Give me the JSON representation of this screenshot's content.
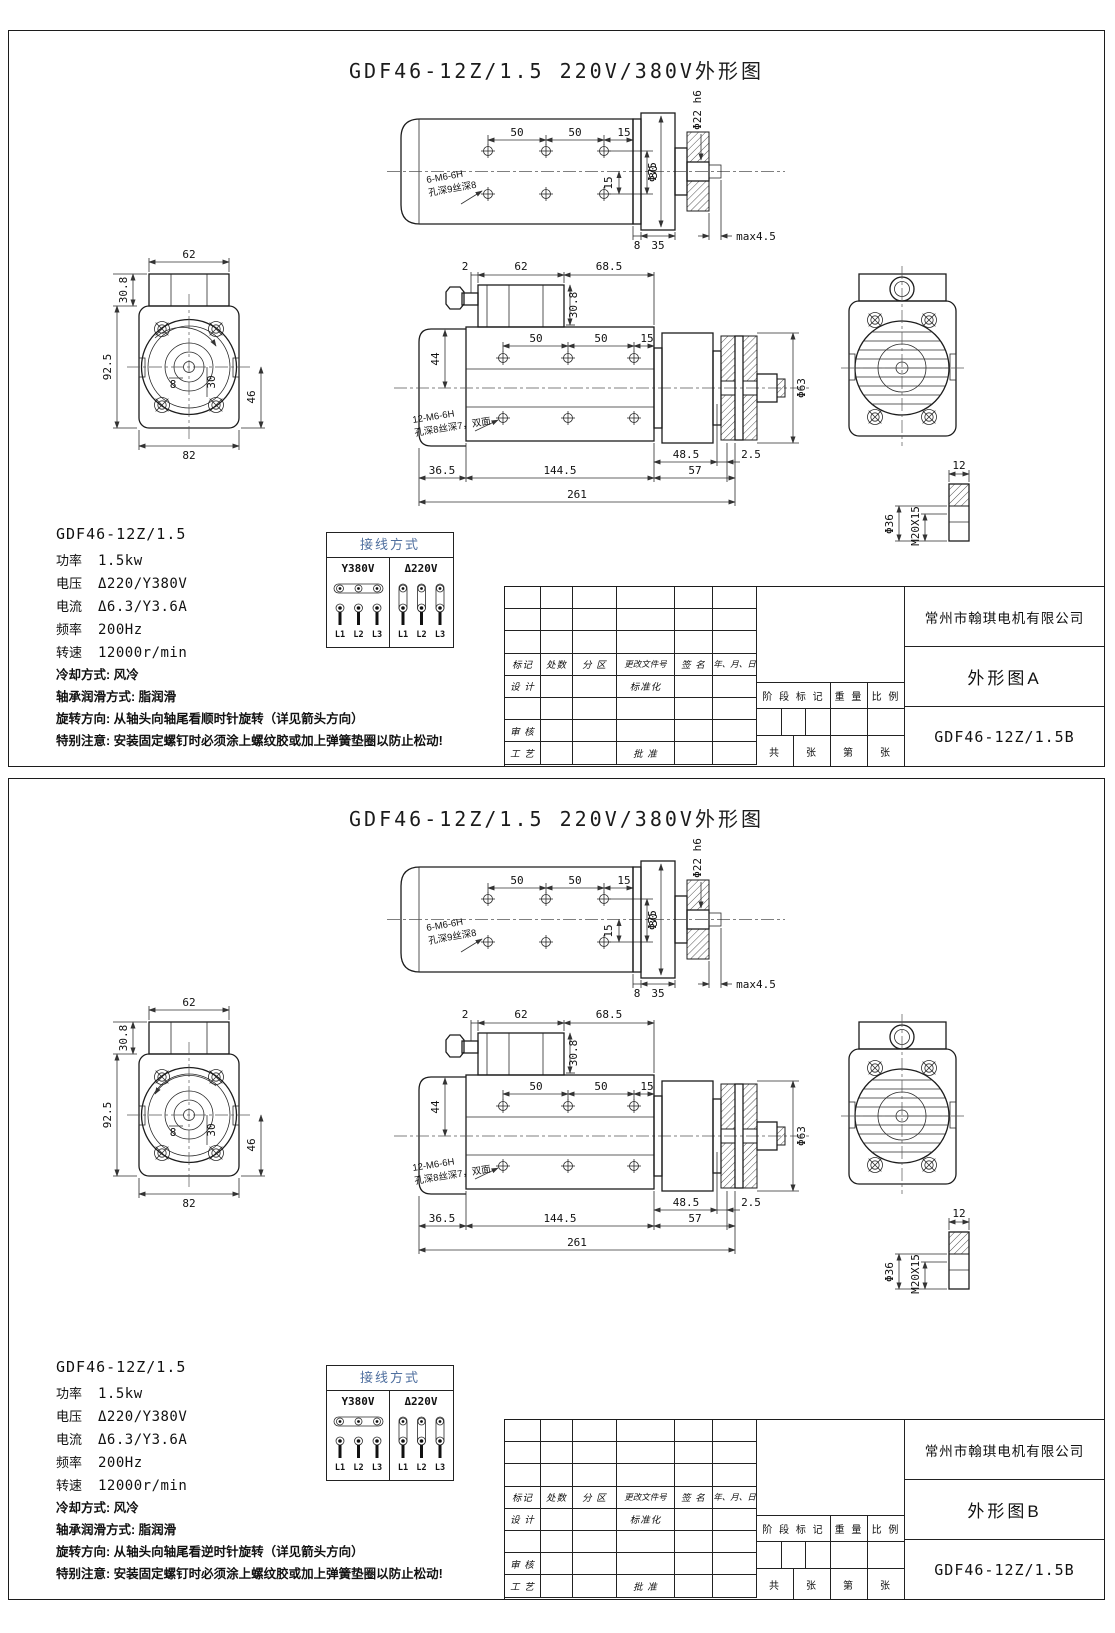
{
  "sheet_title": "GDF46-12Z/1.5 220V/380V外形图",
  "views": {
    "top_view": {
      "dim_50a": "50",
      "dim_50b": "50",
      "dim_15": "15",
      "dim_v30": "30",
      "dim_v15": "15",
      "dim_phi75": "Φ75",
      "dim_phi22": "Φ22 h6",
      "dim_8": "8",
      "dim_35": "35",
      "dim_max": "max4.5",
      "note_line1": "6-M6-6H",
      "note_line2": "孔深9丝深8"
    },
    "end_view": {
      "dim_62": "62",
      "dim_30_8": "30.8",
      "dim_92_5": "92.5",
      "dim_82": "82",
      "dim_46": "46",
      "dim_8": "8",
      "dim_30": "30"
    },
    "front_view": {
      "dim_2": "2",
      "dim_62": "62",
      "dim_68_5": "68.5",
      "dim_30_8": "30.8",
      "dim_50a": "50",
      "dim_50b": "50",
      "dim_15": "15",
      "dim_44": "44",
      "dim_phi63": "Φ63",
      "dim_48_5": "48.5",
      "dim_2_5": "2.5",
      "dim_36_5": "36.5",
      "dim_144_5": "144.5",
      "dim_57": "57",
      "dim_261": "261",
      "note_line1": "12-M6-6H",
      "note_line2": "孔深8丝深7，双面"
    },
    "detail_view": {
      "dim_12": "12",
      "dim_phi36": "Φ36",
      "dim_thread": "M20X15"
    }
  },
  "specs": {
    "model": "GDF46-12Z/1.5",
    "rows": [
      {
        "label": "功率",
        "value": "1.5kw"
      },
      {
        "label": "电压",
        "value": "Δ220/Y380V"
      },
      {
        "label": "电流",
        "value": "Δ6.3/Y3.6A"
      },
      {
        "label": "频率",
        "value": "200Hz"
      },
      {
        "label": "转速",
        "value": "12000r/min"
      }
    ],
    "cooling": "冷却方式: 风冷",
    "lubrication": "轴承润滑方式: 脂润滑",
    "special_note": "特别注意: 安装固定螺钉时必须涂上螺纹胶或加上弹簧垫圈以防止松动!"
  },
  "wiring": {
    "header": "接线方式",
    "col_y": "Y380V",
    "col_d": "Δ220V",
    "terminals": [
      "L1",
      "L2",
      "L3"
    ]
  },
  "title_block": {
    "company": "常州市翰琪电机有限公司",
    "drawing_no": "GDF46-12Z/1.5B",
    "labels": {
      "biaoji": "标记",
      "chushu": "处数",
      "fenqu": "分 区",
      "genggai": "更改文件号",
      "qianming": "签 名",
      "riqi": "年、月、日",
      "sheji": "设 计",
      "biaozhunhua": "标准化",
      "shenhe": "审 核",
      "gongyi": "工 艺",
      "pizhun": "批 准",
      "jieduan": "阶 段 标 记",
      "zhongliang": "重 量",
      "bili": "比 例",
      "gong": "共",
      "zhang1": "张",
      "di": "第",
      "zhang2": "张"
    }
  },
  "panels": [
    {
      "name": "外形图A",
      "rotation_note": "旋转方向: 从轴头向轴尾看顺时针旋转（详见箭头方向）",
      "rotation_dir": "clockwise"
    },
    {
      "name": "外形图B",
      "rotation_note": "旋转方向: 从轴头向轴尾看逆时针旋转（详见箭头方向）",
      "rotation_dir": "counterclockwise"
    }
  ]
}
